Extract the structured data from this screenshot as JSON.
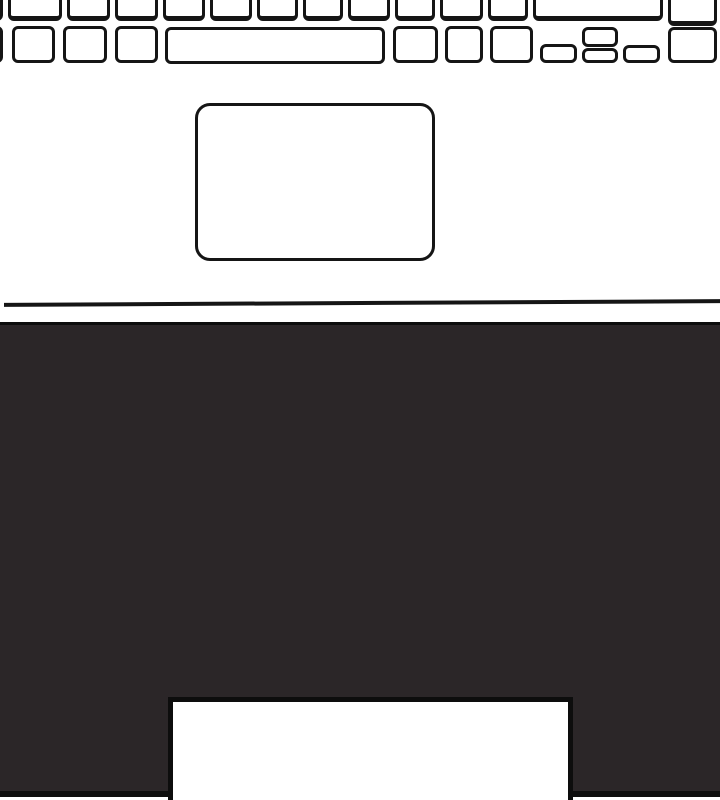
{
  "meta": {
    "description": "Black-and-white line illustration of a laptop palm rest area: bottom keyboard rows (cut off at top), touchpad, palm-rest front edge line, and dark front base with a white rectangular cutout at bottom center",
    "colors": {
      "background": "#ffffff",
      "outline": "#151515",
      "base_fill": "#2b2628",
      "edge": "#0d0d0d"
    }
  },
  "keyboard": {
    "keys": [
      {
        "name": "key",
        "row": 1,
        "x": -40,
        "y": -16,
        "w": 43,
        "h": 37
      },
      {
        "name": "key",
        "row": 1,
        "x": 8,
        "y": -16,
        "w": 54,
        "h": 37
      },
      {
        "name": "key",
        "row": 1,
        "x": 67,
        "y": -16,
        "w": 43,
        "h": 37
      },
      {
        "name": "key",
        "row": 1,
        "x": 115,
        "y": -16,
        "w": 43,
        "h": 37
      },
      {
        "name": "key",
        "row": 1,
        "x": 163,
        "y": -16,
        "w": 42,
        "h": 37
      },
      {
        "name": "key",
        "row": 1,
        "x": 210,
        "y": -16,
        "w": 42,
        "h": 37
      },
      {
        "name": "key",
        "row": 1,
        "x": 257,
        "y": -16,
        "w": 41,
        "h": 37
      },
      {
        "name": "key",
        "row": 1,
        "x": 303,
        "y": -16,
        "w": 40,
        "h": 37
      },
      {
        "name": "key",
        "row": 1,
        "x": 348,
        "y": -16,
        "w": 42,
        "h": 37
      },
      {
        "name": "key",
        "row": 1,
        "x": 395,
        "y": -16,
        "w": 40,
        "h": 37
      },
      {
        "name": "key",
        "row": 1,
        "x": 440,
        "y": -16,
        "w": 43,
        "h": 37
      },
      {
        "name": "key",
        "row": 1,
        "x": 488,
        "y": -16,
        "w": 40,
        "h": 37
      },
      {
        "name": "wide-key",
        "row": 1,
        "x": 533,
        "y": -16,
        "w": 130,
        "h": 37
      },
      {
        "name": "key",
        "row": 1,
        "x": 668,
        "y": -16,
        "w": 49,
        "h": 42
      },
      {
        "name": "key",
        "row": 2,
        "x": -30,
        "y": 26,
        "w": 33,
        "h": 37
      },
      {
        "name": "key",
        "row": 2,
        "x": 12,
        "y": 26,
        "w": 43,
        "h": 37
      },
      {
        "name": "key",
        "row": 2,
        "x": 63,
        "y": 26,
        "w": 44,
        "h": 37
      },
      {
        "name": "key",
        "row": 2,
        "x": 115,
        "y": 26,
        "w": 43,
        "h": 37
      },
      {
        "name": "spacebar-key",
        "row": 2,
        "x": 165,
        "y": 27,
        "w": 220,
        "h": 37
      },
      {
        "name": "key",
        "row": 2,
        "x": 393,
        "y": 26,
        "w": 45,
        "h": 37
      },
      {
        "name": "key",
        "row": 2,
        "x": 445,
        "y": 26,
        "w": 38,
        "h": 37
      },
      {
        "name": "key",
        "row": 2,
        "x": 490,
        "y": 26,
        "w": 43,
        "h": 37
      },
      {
        "name": "arrow-left-key",
        "row": 2,
        "x": 540,
        "y": 44,
        "w": 37,
        "h": 19
      },
      {
        "name": "arrow-up-key",
        "row": 2,
        "x": 582,
        "y": 27,
        "w": 36,
        "h": 20
      },
      {
        "name": "arrow-down-key",
        "row": 2,
        "x": 582,
        "y": 48,
        "w": 36,
        "h": 15
      },
      {
        "name": "arrow-right-key",
        "row": 2,
        "x": 623,
        "y": 45,
        "w": 37,
        "h": 18
      },
      {
        "name": "key",
        "row": 2,
        "x": 668,
        "y": 27,
        "w": 49,
        "h": 36
      }
    ]
  },
  "touchpad": {
    "x": 195,
    "y": 103,
    "w": 240,
    "h": 158,
    "radius": 15
  },
  "front_edge_line": {
    "x": 4,
    "y": 301,
    "w": 716,
    "h": 4
  },
  "base": {
    "x": 0,
    "y": 322,
    "w": 720,
    "h": 475
  },
  "base_cutout": {
    "x": 168,
    "y": 697,
    "w": 405,
    "h": 103
  }
}
